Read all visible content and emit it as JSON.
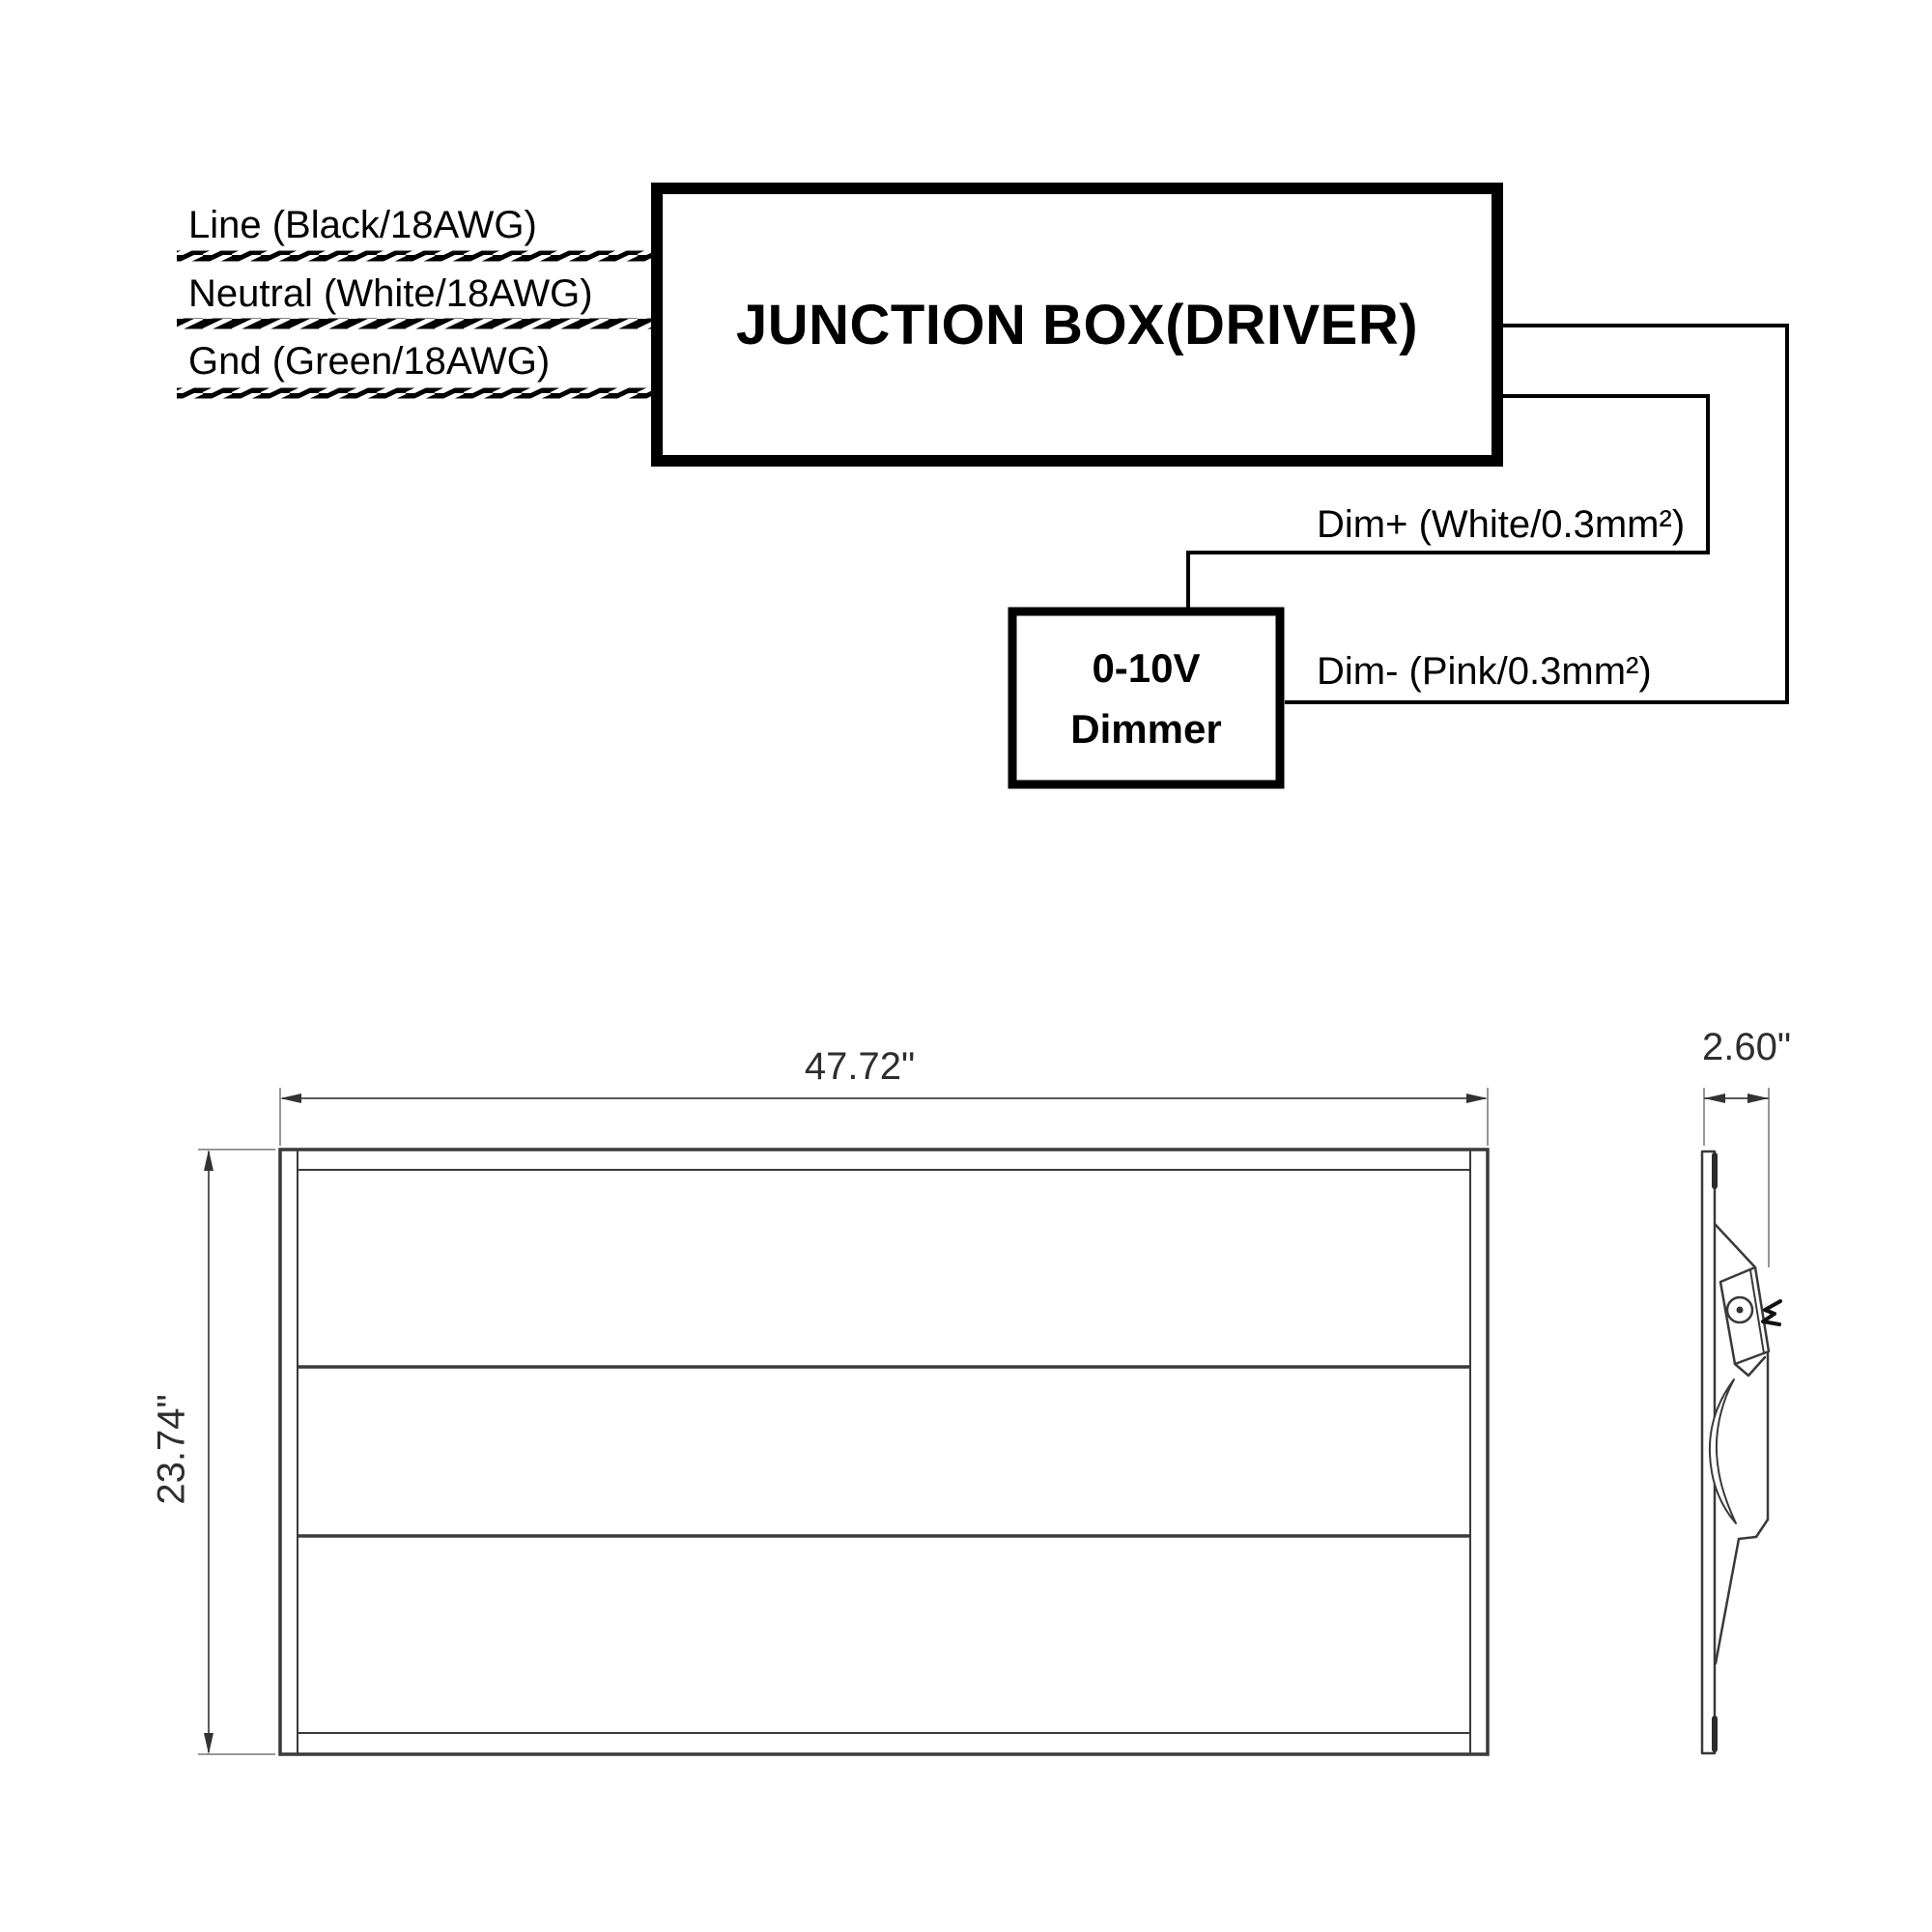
{
  "wiring": {
    "junction_box_label": "JUNCTION BOX(DRIVER)",
    "input_wires": [
      {
        "label": "Line (Black/18AWG)"
      },
      {
        "label": "Neutral (White/18AWG)"
      },
      {
        "label": "Gnd (Green/18AWG)"
      }
    ],
    "dim_plus_label": "Dim+ (White/0.3mm²)",
    "dim_minus_label": "Dim- (Pink/0.3mm²)",
    "dimmer": {
      "line1": "0-10V",
      "line2": "Dimmer"
    }
  },
  "drawing": {
    "width_label": "47.72\"",
    "height_label": "23.74\"",
    "depth_label": "2.60\""
  },
  "colors": {
    "ink": "#000000",
    "drawing_stroke": "#3a3a3a",
    "dimension_line": "#5a5a5a",
    "extension_line": "#8a8a8a"
  }
}
